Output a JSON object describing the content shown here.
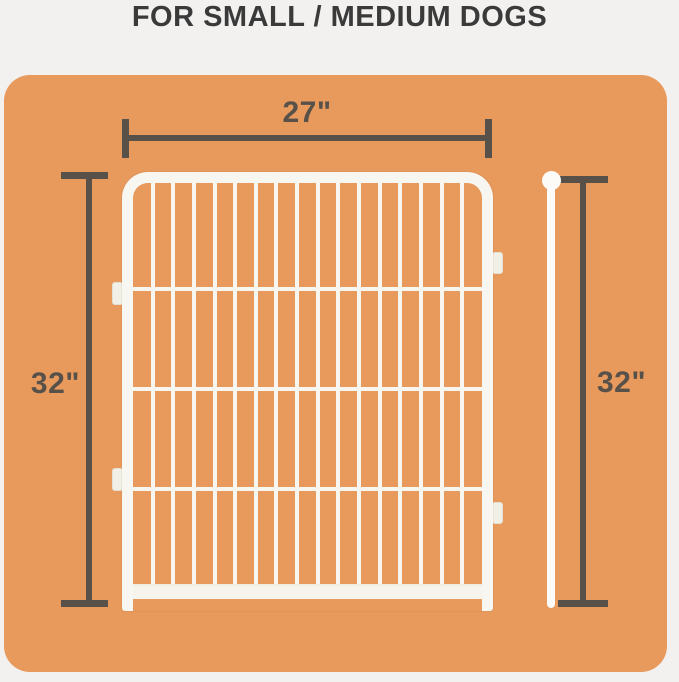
{
  "page": {
    "title": "FOR SMALL / MEDIUM DOGS",
    "background_color": "#f2f1ef",
    "title_color": "#3a3a3a"
  },
  "board": {
    "color": "#e8995c"
  },
  "dimensions": {
    "line_color": "#57514a",
    "width_label": "27\"",
    "height_label_left": "32\"",
    "height_label_right": "32\""
  },
  "panel": {
    "description": "white wire pen panel",
    "color": "#f8f6f0",
    "vertical_bar_count": 16,
    "horizontal_bar_count": 3,
    "connector_tab_count": 4
  },
  "rod": {
    "description": "white ground stake with ball top",
    "color": "#fcfbf7"
  }
}
